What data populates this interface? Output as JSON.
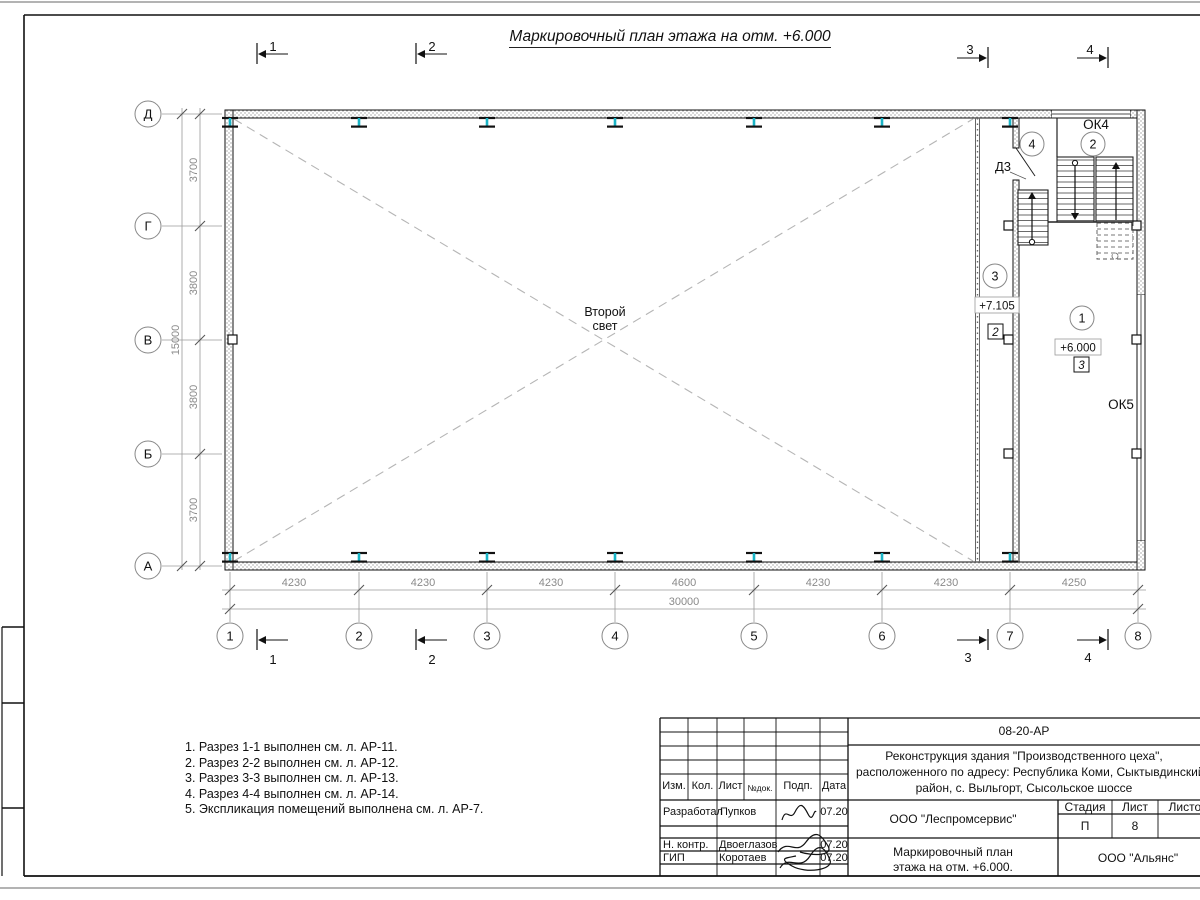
{
  "sheet": {
    "title": "Маркировочный план этажа на отм. +6.000"
  },
  "plan": {
    "center_label_line1": "Второй",
    "center_label_line2": "свет",
    "door_label": "Д3",
    "window_top_label": "ОК4",
    "window_right_label": "ОК5",
    "elevation_upper": "+7.105",
    "elevation_main": "+6.000",
    "room_numbers": [
      "1",
      "2",
      "3",
      "4"
    ],
    "floor_marks": [
      "2",
      "3"
    ]
  },
  "grid": {
    "columns": [
      "1",
      "2",
      "3",
      "4",
      "5",
      "6",
      "7",
      "8"
    ],
    "rows": [
      "Д",
      "Г",
      "В",
      "Б",
      "А"
    ]
  },
  "dimensions": {
    "bottom": [
      "4230",
      "4230",
      "4230",
      "4600",
      "4230",
      "4230",
      "4250"
    ],
    "bottom_total": "30000",
    "left": [
      "3700",
      "3800",
      "3800",
      "3700"
    ],
    "left_total": "15000"
  },
  "sections": {
    "marks": [
      "1",
      "2",
      "3",
      "4"
    ]
  },
  "notes": [
    "1. Разрез 1-1 выполнен см. л. АР-11.",
    "2. Разрез 2-2 выполнен см. л. АР-12.",
    "3. Разрез 3-3 выполнен см. л. АР-13.",
    "4. Разрез 4-4 выполнен см. л. АР-14.",
    "5. Экспликация помещений выполнена см. л. АР-7."
  ],
  "title_block": {
    "doc_number": "08-20-АР",
    "project_line1": "Реконструкция здания \"Производственного цеха\",",
    "project_line2": "расположенного по адресу: Республика Коми, Сыктывдинский",
    "project_line3": "район, с. Выльгорт, Сысольское шоссе",
    "col_headers": {
      "izm": "Изм.",
      "kol": "Кол.",
      "list": "Лист",
      "ndoc": "№док.",
      "podp": "Подп.",
      "data": "Дата"
    },
    "rows": [
      {
        "role": "Разработал",
        "name": "Пупков",
        "date": "07.20"
      },
      {
        "role": "Н. контр.",
        "name": "Двоеглазов",
        "date": "07.20"
      },
      {
        "role": "ГИП",
        "name": "Коротаев",
        "date": "07.20"
      }
    ],
    "org": "ООО \"Леспромсервис\"",
    "drawing_title_line1": "Маркировочный план",
    "drawing_title_line2": "этажа на отм. +6.000.",
    "stage_label": "Стадия",
    "sheet_label": "Лист",
    "sheets_label": "Листов",
    "stage_value": "П",
    "sheet_value": "8",
    "contractor": "ООО \"Альянс\""
  },
  "colors": {
    "beam_cyan": "#1ab4c6",
    "dim_gray": "#8a8a8a",
    "dash_gray": "#b5b5b5",
    "line_black": "#111111"
  }
}
